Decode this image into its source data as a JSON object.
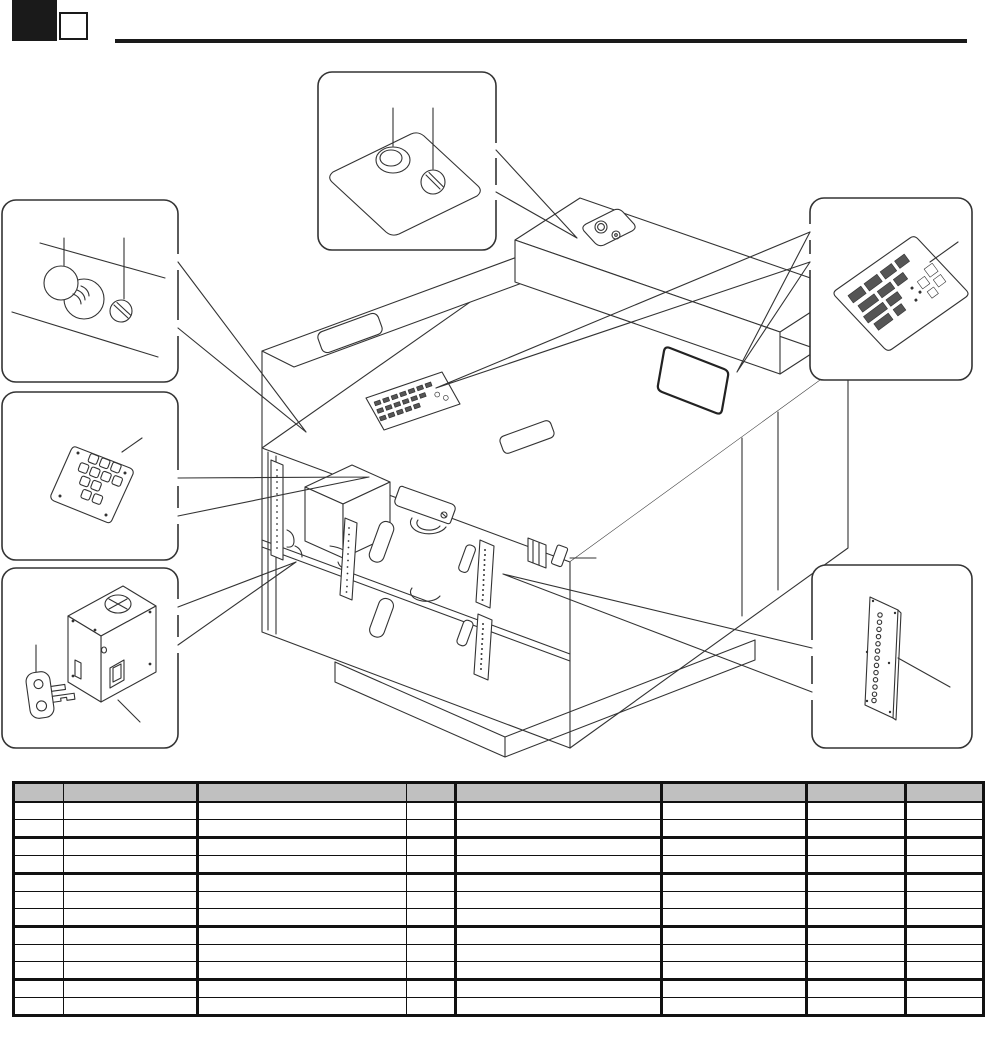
{
  "page": {
    "background": "#ffffff",
    "line_color": "#333333",
    "accent_black": "#1a1a1a"
  },
  "header": {
    "section_marker_filled": "black-square",
    "section_marker_outline": "outline-square",
    "rule": "horizontal-rule"
  },
  "diagram": {
    "type": "exploded-parts-diagram",
    "subject": "copier-machine-isometric-view",
    "callouts": [
      {
        "id": "callout-top",
        "icon": "key-switch-plate-icon",
        "details": [
          "oval-button-icon",
          "keyed-knob-icon"
        ]
      },
      {
        "id": "callout-left-upper",
        "icon": "control-knobs-icon",
        "details": [
          "round-knob-icon",
          "slotted-knob-icon"
        ]
      },
      {
        "id": "callout-left-middle",
        "icon": "keypad-board-icon",
        "details": [
          "key-buttons-icon"
        ]
      },
      {
        "id": "callout-left-lower",
        "icon": "key-counter-unit-icon",
        "details": [
          "counter-box-icon",
          "key-icon"
        ]
      },
      {
        "id": "callout-right-upper",
        "icon": "pcb-board-icon",
        "details": [
          "connector-blocks-icon"
        ]
      },
      {
        "id": "callout-right-lower",
        "icon": "indicator-strip-panel-icon",
        "details": [
          "hole-column-icon"
        ]
      }
    ],
    "machine_features": [
      "operation-panel-icon",
      "key-switch-plate-icon",
      "rating-label-icon",
      "front-doors-icon",
      "door-handles-icon",
      "led-strip-icon",
      "toner-box-icon",
      "base-plinth-icon"
    ]
  },
  "table": {
    "x": 12,
    "y": 781,
    "header_fill": "#c0c0c0",
    "border_color": "#111111",
    "row_count": 12,
    "thick_bottom_after_rows": [
      2,
      4,
      7,
      10
    ],
    "columns": [
      {
        "name": "col-1",
        "width": 48,
        "thick_right": false,
        "header_label": ""
      },
      {
        "name": "col-2",
        "width": 133,
        "thick_right": true,
        "header_label": ""
      },
      {
        "name": "col-3",
        "width": 208,
        "thick_right": false,
        "header_label": ""
      },
      {
        "name": "col-4",
        "width": 48,
        "thick_right": true,
        "header_label": ""
      },
      {
        "name": "col-5",
        "width": 204,
        "thick_right": true,
        "header_label": ""
      },
      {
        "name": "col-6",
        "width": 143,
        "thick_right": true,
        "header_label": ""
      },
      {
        "name": "col-7",
        "width": 97,
        "thick_right": true,
        "header_label": ""
      },
      {
        "name": "col-8",
        "width": 75,
        "thick_right": false,
        "header_label": ""
      }
    ],
    "cell_values_empty": true
  }
}
